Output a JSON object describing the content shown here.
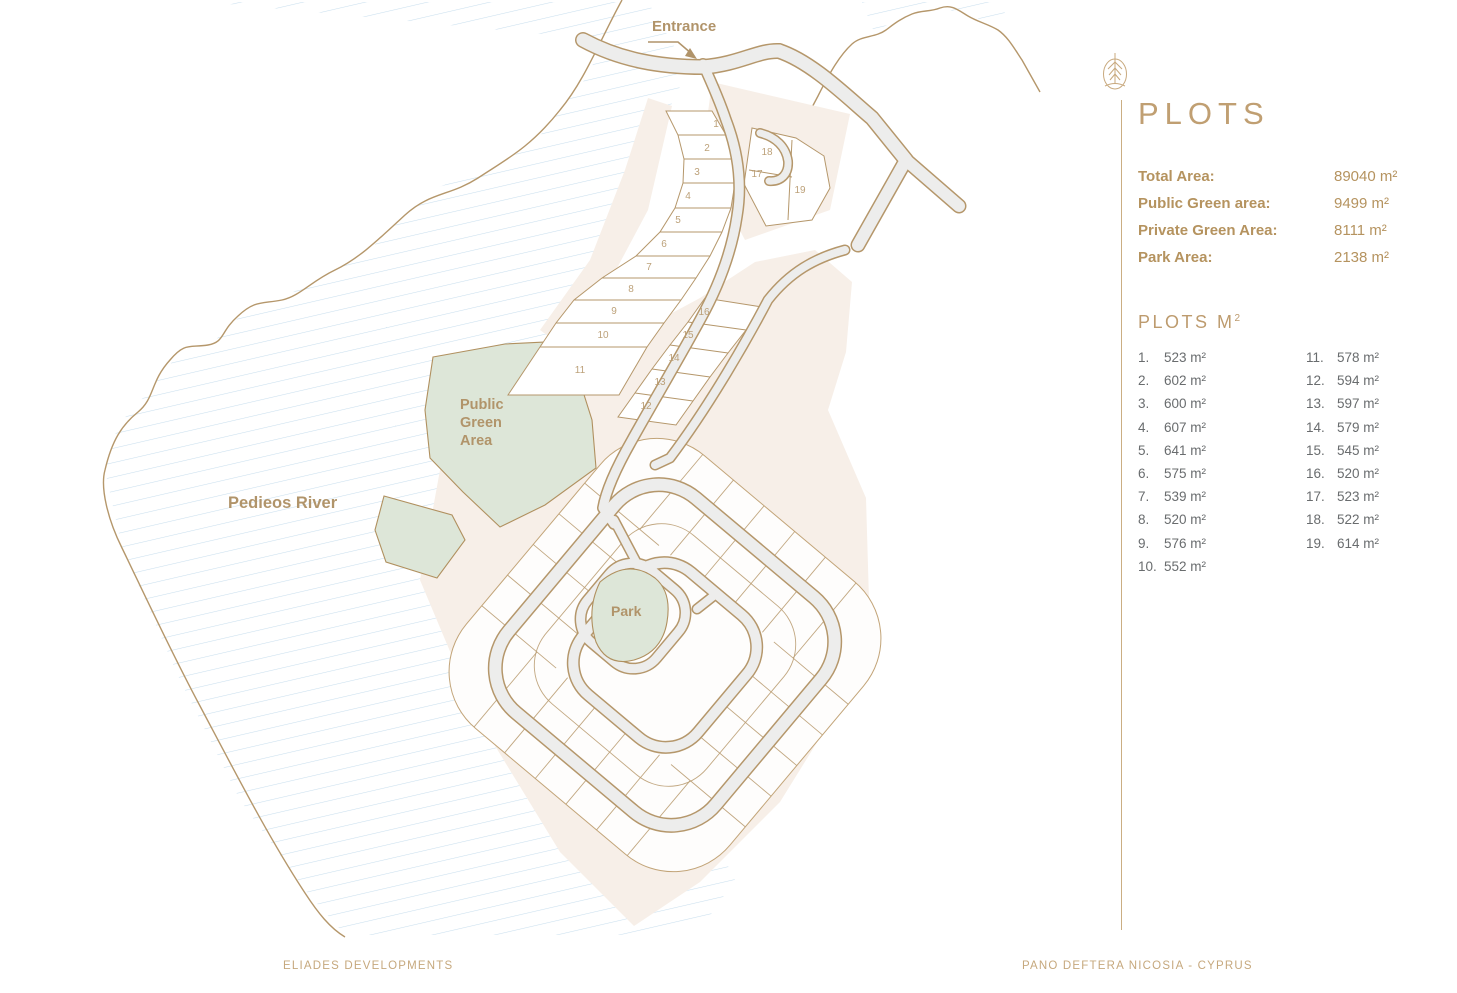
{
  "colors": {
    "accent_tan": "#b5976b",
    "label_tan": "#b1946a",
    "title_tan": "#c09f72",
    "list_gray": "#696c6e",
    "road_gray": "#ededec",
    "beige": "#f7efe8",
    "green": "#dde6d8",
    "hatch_blue": "#c9dfee"
  },
  "map": {
    "labels": {
      "entrance": "Entrance",
      "river": "Pedieos River",
      "public_green": [
        "Public",
        "Green",
        "Area"
      ],
      "park": "Park"
    },
    "plot_numbers": [
      {
        "n": "1"
      },
      {
        "n": "2"
      },
      {
        "n": "3"
      },
      {
        "n": "4"
      },
      {
        "n": "5"
      },
      {
        "n": "6"
      },
      {
        "n": "7"
      },
      {
        "n": "8"
      },
      {
        "n": "9"
      },
      {
        "n": "10"
      },
      {
        "n": "11"
      },
      {
        "n": "12"
      },
      {
        "n": "13"
      },
      {
        "n": "14"
      },
      {
        "n": "15"
      },
      {
        "n": "16"
      },
      {
        "n": "17"
      },
      {
        "n": "18"
      },
      {
        "n": "19"
      }
    ]
  },
  "panel": {
    "title": "PLOTS",
    "stats": [
      {
        "label": "Total Area:",
        "value": "89040 m²"
      },
      {
        "label": "Public Green area:",
        "value": "9499 m²"
      },
      {
        "label": "Private Green Area:",
        "value": "8111 m²"
      },
      {
        "label": "Park Area:",
        "value": "2138 m²"
      }
    ],
    "list_title": "PLOTS M",
    "list_title_sup": "2",
    "plots_col1": [
      {
        "num": "1.",
        "area": "523 m²"
      },
      {
        "num": "2.",
        "area": "602 m²"
      },
      {
        "num": "3.",
        "area": "600 m²"
      },
      {
        "num": "4.",
        "area": "607 m²"
      },
      {
        "num": "5.",
        "area": "641 m²"
      },
      {
        "num": "6.",
        "area": "575 m²"
      },
      {
        "num": "7.",
        "area": "539 m²"
      },
      {
        "num": "8.",
        "area": "520 m²"
      },
      {
        "num": "9.",
        "area": "576 m²"
      },
      {
        "num": "10.",
        "area": "552 m²"
      }
    ],
    "plots_col2": [
      {
        "num": "11.",
        "area": "578 m²"
      },
      {
        "num": "12.",
        "area": "594 m²"
      },
      {
        "num": "13.",
        "area": "597 m²"
      },
      {
        "num": "14.",
        "area": "579 m²"
      },
      {
        "num": "15.",
        "area": "545 m²"
      },
      {
        "num": "16.",
        "area": "520 m²"
      },
      {
        "num": "17.",
        "area": "523 m²"
      },
      {
        "num": "18.",
        "area": "522 m²"
      },
      {
        "num": "19.",
        "area": "614 m²"
      }
    ]
  },
  "footer": {
    "left": "ELIADES DEVELOPMENTS",
    "right": "PANO DEFTERA NICOSIA - CYPRUS"
  }
}
